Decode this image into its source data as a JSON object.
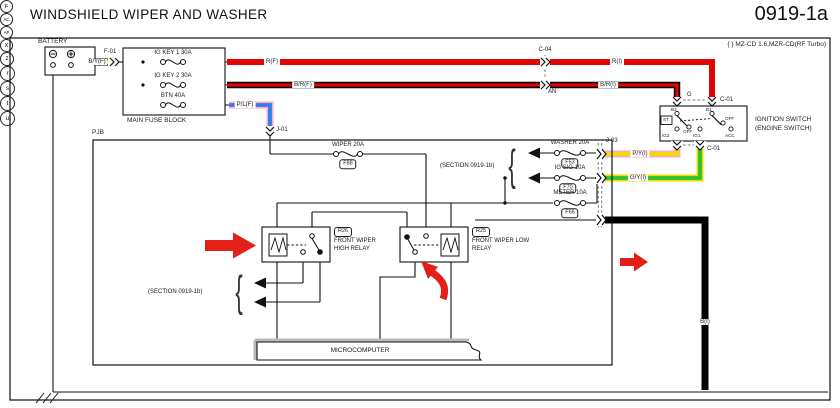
{
  "header": {
    "title": "WINDSHIELD WIPER AND WASHER",
    "page_code": "0919-1a",
    "variant_note": "{ } MZ-CD 1.6,MZR-CD(RF Turbo)"
  },
  "battery": {
    "label": "BATTERY",
    "minus": "−",
    "plus": "+"
  },
  "main_fuse_block": {
    "label": "MAIN FUSE BLOCK",
    "fuses": [
      {
        "label": "IG KEY 1 30A"
      },
      {
        "label": "IG KEY 2 30A"
      },
      {
        "label": "BTN 40A"
      }
    ]
  },
  "wires": {
    "byf": "B/Y(F)",
    "rf": "R(F)",
    "brf": "B/R(F)",
    "plf": "P/L(F)",
    "ri": "R(I)",
    "bri": "B/R(I)",
    "pyi": "P/Y(I)",
    "gyi": "G/Y(I)",
    "bi": "B(I)",
    "g": "G",
    "an": "AN"
  },
  "connectors": {
    "f01": "F-01",
    "c04": "C-04",
    "j01": "J-01",
    "j01_circle": "F",
    "c01_top": "C-01",
    "c01_bottom": "C-01",
    "j03": "J-03",
    "ac": "AC",
    "ap": "AP",
    "x": "X",
    "z": "z"
  },
  "ignition_switch": {
    "name_line1": "IGNITION SWITCH",
    "name_line2": "(ENGINE SWITCH)",
    "b2": "B2",
    "b1": "B1",
    "st": "ST",
    "off_left": "OFF",
    "off_right": "OFF",
    "ig2": "IG2",
    "ig1": "IG1",
    "acc": "ACC"
  },
  "pjb": {
    "label": "PJB",
    "wiper_fuse": {
      "label": "WIPER 20A",
      "ref": "F88"
    },
    "washer_fuse": {
      "label": "WASHER 20A",
      "ref": "F53"
    },
    "igsig_fuse": {
      "label": "IG SIG 10A",
      "ref": "F70"
    },
    "meter_fuse": {
      "label": "METER 10A",
      "ref": "F66"
    },
    "relay_high": {
      "ref": "R26",
      "line1": "FRONT WIPER",
      "line2": "HIGH RELAY"
    },
    "relay_low": {
      "ref": "R25",
      "line1": "FRONT WIPER LOW",
      "line2": "RELAY"
    },
    "microcomputer": "MICROCOMPUTER"
  },
  "sections": {
    "left": {
      "label": "(SECTION 0919-1b)",
      "points": [
        "t",
        "u"
      ]
    },
    "right": {
      "label": "(SECTION 0919-1b)",
      "points": [
        "r",
        "s"
      ]
    }
  },
  "colors": {
    "red": "#e10505",
    "yellow": "#f0dc00",
    "green": "#2ec22e",
    "blue": "#2f7df0",
    "pink": "#ffa8c0",
    "black": "#000000",
    "arrow_red": "#e32017"
  }
}
